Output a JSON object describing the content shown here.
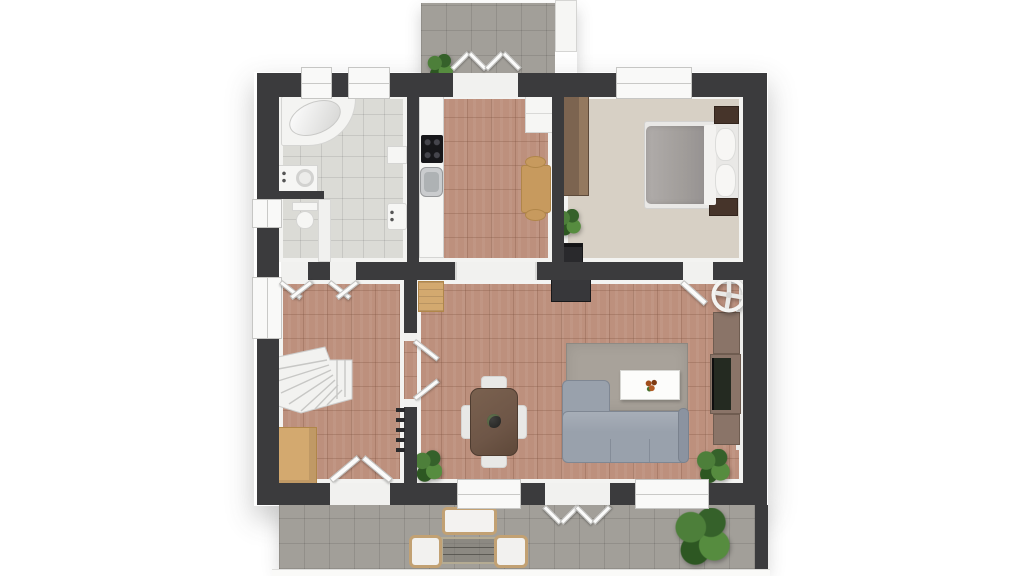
{
  "meta": {
    "title": "3D floor plan, top-down view (no visible text in image)",
    "style": "architectural 3D dollhouse render on white background"
  },
  "palette": {
    "wall": "#3b3b3d",
    "trim": "#f3f3f1",
    "floor-terracotta": "#bd907d",
    "floor-bath": "#dbdbd6",
    "floor-bedroom": "#d7d0c5",
    "floor-outdoor": "#a29f99",
    "wood-tan": "#d3a96f",
    "wood-mid": "#c79a5e",
    "wood-brown": "#6e5647",
    "wood-dark": "#46342a",
    "wardrobe-brown": "#7c6450",
    "tv-unit-brown": "#8a7468",
    "sofa-gray": "#99a1ac",
    "rug-gray": "#a8a29a",
    "black-furniture": "#29292c",
    "plant-green": "#4c7a3b",
    "white-fixture": "#f6f6f4"
  },
  "rooms": {
    "bathroom": {
      "label": "Bathroom",
      "floor": "light gray tile",
      "furniture": [
        "corner bathtub",
        "washing machine",
        "washbasin",
        "wall cabinet"
      ]
    },
    "wc": {
      "label": "WC",
      "floor": "light gray tile",
      "furniture": [
        "toilet"
      ]
    },
    "kitchen": {
      "label": "Kitchen",
      "floor": "terracotta tile",
      "furniture": [
        "counter run",
        "cooktop",
        "sink",
        "fridge cabinet",
        "small table",
        "2 stools"
      ]
    },
    "bedroom": {
      "label": "Bedroom",
      "floor": "beige carpet",
      "furniture": [
        "double bed",
        "2 nightstands",
        "wardrobe",
        "dark dresser",
        "plant"
      ]
    },
    "hallway": {
      "label": "Hallway",
      "floor": "terracotta tile",
      "furniture": [
        "winder staircase",
        "shoe cabinet",
        "coat hooks"
      ]
    },
    "living": {
      "label": "Living / dining room",
      "floor": "terracotta tile",
      "furniture": [
        "corner sofa",
        "area rug",
        "coffee table with flowers",
        "tv wall unit",
        "dark sideboard",
        "ceiling fan",
        "dining table",
        "4 chairs",
        "tan console",
        "2 plants"
      ]
    },
    "balcony": {
      "label": "Balcony",
      "floor": "gray tile",
      "furniture": [
        "plant",
        "white planter box"
      ]
    },
    "terrace": {
      "label": "Terrace",
      "floor": "gray tile",
      "furniture": [
        "outdoor bench",
        "glass table",
        "2 wicker chairs",
        "large plant"
      ]
    }
  },
  "openings": {
    "window_count": 7,
    "windows": [
      "bathroom top window 1",
      "bathroom top window 2",
      "bedroom top window",
      "wc left window",
      "hallway left window",
      "living bottom window 1",
      "living bottom window 2"
    ],
    "exterior_doors": [
      "balcony french doors (open)",
      "front door (open)",
      "terrace french doors (open)"
    ],
    "interior_doors": [
      "wc door (open)",
      "bathroom door (open)",
      "bedroom door (open)",
      "hallway-living double door (open)"
    ],
    "passages": [
      "kitchen to living room open passage"
    ]
  }
}
